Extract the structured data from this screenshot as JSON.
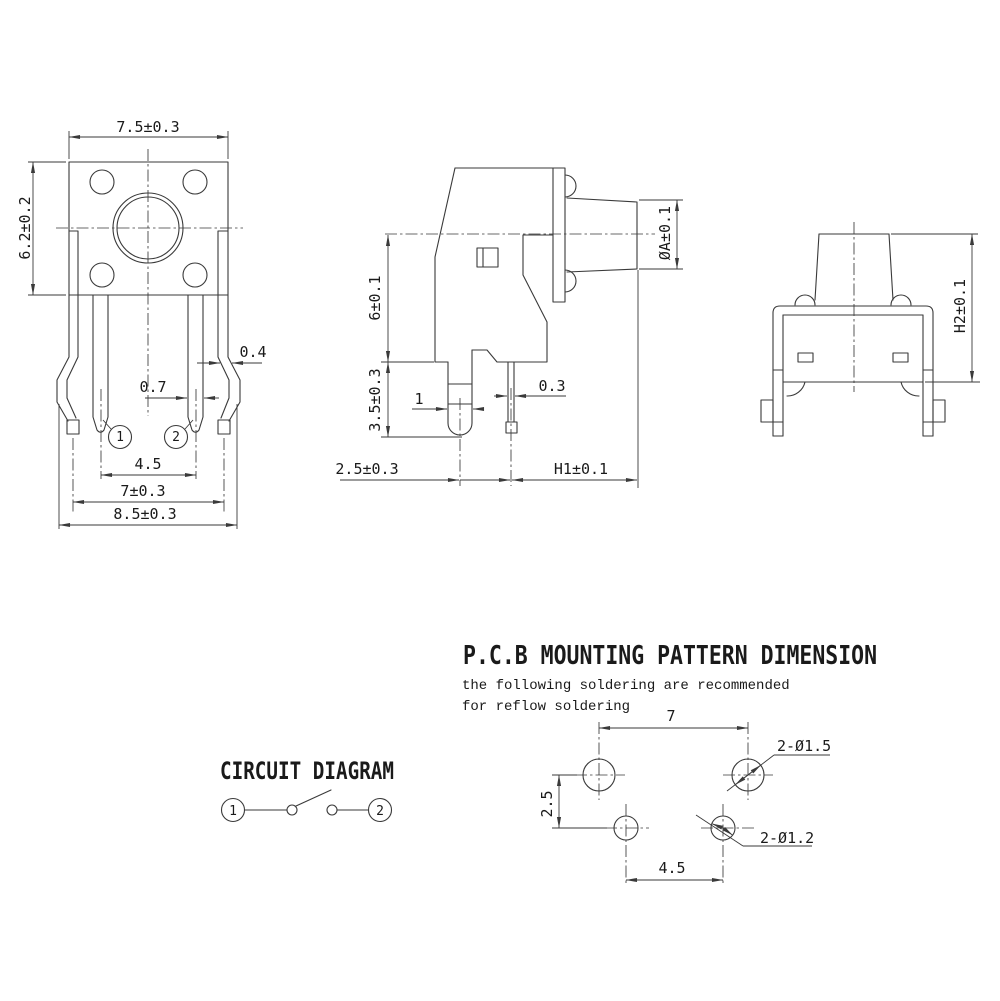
{
  "front_view": {
    "dim_width_top": "7.5±0.3",
    "dim_height_left": "6.2±0.2",
    "dim_bracket_thickness": "0.4",
    "dim_pin_width": "0.7",
    "dim_pin_pitch": "4.5",
    "dim_leg_pitch": "7±0.3",
    "dim_overall_width": "8.5±0.3",
    "pin1": "1",
    "pin2": "2"
  },
  "side_view": {
    "dim_body_height": "6±0.1",
    "dim_pin_length": "3.5±0.3",
    "dim_peg_width": "1",
    "dim_pin_thickness": "0.3",
    "dim_peg_to_pin": "2.5±0.3",
    "dim_h1": "H1±0.1",
    "dim_button_diameter": "ØA±0.1"
  },
  "rear_view": {
    "dim_h2": "H2±0.1"
  },
  "circuit_diagram": {
    "title": "CIRCUIT DIAGRAM",
    "terminal1": "1",
    "terminal2": "2"
  },
  "pcb_pattern": {
    "title": "P.C.B MOUNTING PATTERN DIMENSION",
    "note_line1": "the following soldering are recommended",
    "note_line2": "for reflow soldering",
    "dim_leg_hole_pitch": "7",
    "dim_row_pitch": "2.5",
    "dim_pin_hole_pitch": "4.5",
    "label_leg_holes": "2-Ø1.5",
    "label_pin_holes": "2-Ø1.2"
  },
  "colors": {
    "line": "#3a3a3a",
    "text": "#1a1a1a",
    "background": "#ffffff"
  }
}
